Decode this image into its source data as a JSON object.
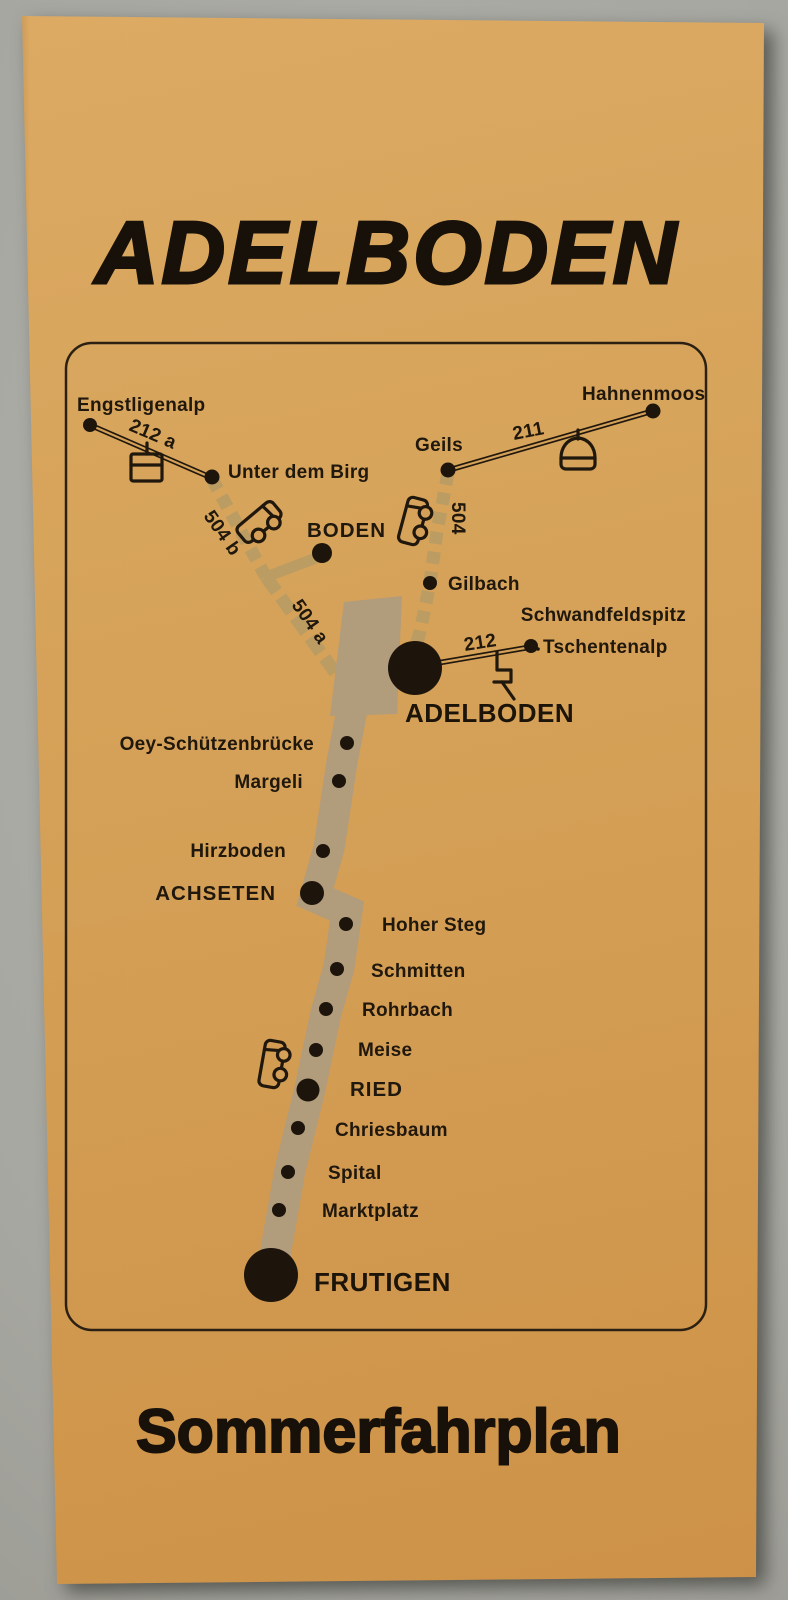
{
  "scene": {
    "background_color": "#a9a9a3",
    "paper_color": "#d5a158",
    "ink_color": "#20170d",
    "road_main_color": "#b19c7c",
    "road_secondary_color": "#bb9c62"
  },
  "brochure": {
    "title": "ADELBODEN",
    "subtitle": "Sommerfahrplan"
  },
  "map": {
    "labels": {
      "engstligenalp": "Engstligenalp",
      "unter_dem_birg": "Unter dem Birg",
      "hahnenmoos": "Hahnenmoos",
      "geils": "Geils",
      "boden": "BODEN",
      "gilbach": "Gilbach",
      "schwandfeldspitz": "Schwandfeldspitz",
      "tschentenalp": "Tschentenalp",
      "adelboden": "ADELBODEN",
      "oey_schuetzenbruecke": "Oey-Schützenbrücke",
      "margeli": "Margeli",
      "hirzboden": "Hirzboden",
      "achseten": "ACHSETEN",
      "hoher_steg": "Hoher Steg",
      "schmitten": "Schmitten",
      "rohrbach": "Rohrbach",
      "meise": "Meise",
      "ried": "RIED",
      "chriesbaum": "Chriesbaum",
      "spital": "Spital",
      "marktplatz": "Marktplatz",
      "frutigen": "FRUTIGEN"
    },
    "routes": {
      "route_211": "211",
      "route_212": "212",
      "route_212a": "212 a",
      "route_504": "504",
      "route_504a": "504 a",
      "route_504b": "504 b"
    },
    "icons": {
      "aerial_tramway": "aerial-tramway-icon",
      "gondola": "gondola-icon",
      "bus": "bus-icon",
      "surface_lift": "surface-lift-icon"
    }
  }
}
